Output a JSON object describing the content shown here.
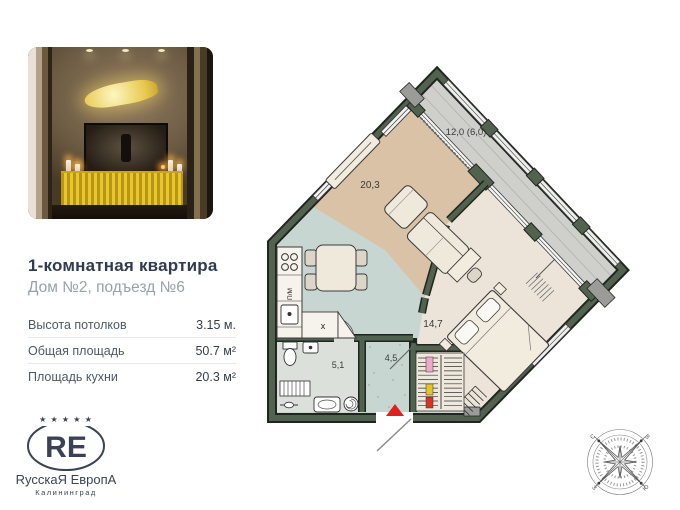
{
  "listing": {
    "title": "1-комнатная квартира",
    "subtitle": "Дом №2, подъезд №6",
    "specs": [
      {
        "label": "Высота потолков",
        "value": "3.15 м."
      },
      {
        "label": "Общая площадь",
        "value": "50.7 м²"
      },
      {
        "label": "Площадь кухни",
        "value": "20.3 м²"
      }
    ]
  },
  "logo": {
    "stars": "★ ★ ★ ★ ★",
    "monogram": "RE",
    "name": "RусскаЯ ЕвропА",
    "city": "Калининград"
  },
  "floorplan": {
    "areas": {
      "living_kitchen": "20,3",
      "bedroom": "14,7",
      "hallway": "4,5",
      "bathroom": "5,1",
      "balcony": "12,0 (6,0)"
    },
    "labels": {
      "dishwasher": "П/М",
      "washer": "x"
    },
    "compass": {
      "n": "С",
      "e": "В",
      "s": "Ю",
      "w": "З"
    }
  },
  "colors": {
    "title": "#2e3b52",
    "logo_navy": "#3a4257",
    "accent_red": "#e01f1f",
    "wall_green": "#51624f",
    "floor_tan": "#d9c2a6",
    "floor_teal": "#c8d6d2",
    "floor_balcony": "#cfcfcc",
    "floor_bedroom": "#ece4d8"
  }
}
